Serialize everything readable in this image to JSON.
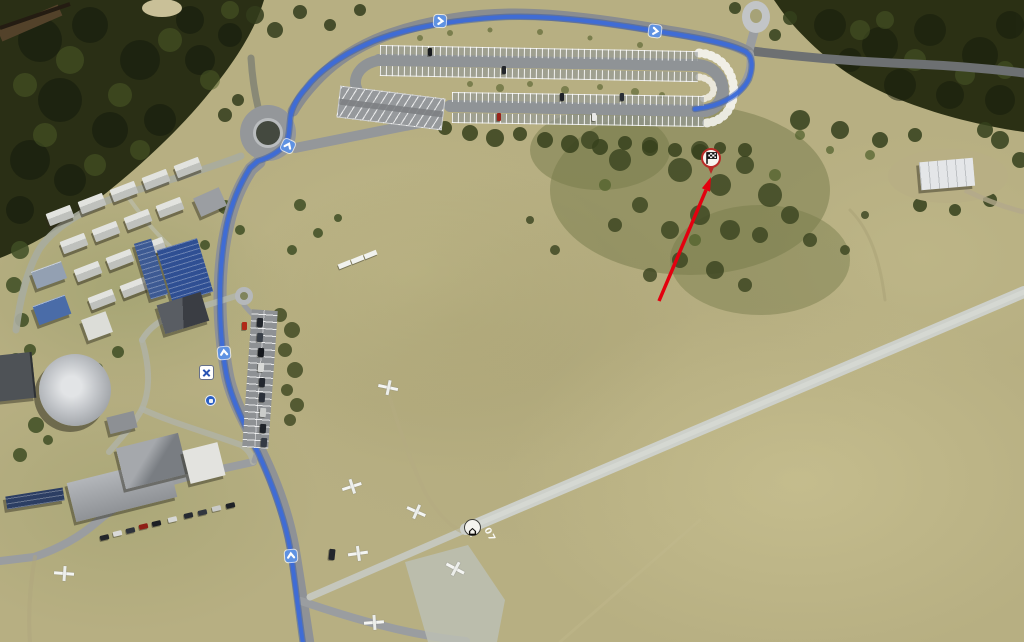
{
  "view": {
    "type": "aerial-satellite-route-map",
    "description": "Aerial imagery of a mountain airfield and resort village with a highlighted driving route, direction chevrons and a flagged destination marker"
  },
  "colors": {
    "route": "#3d6cd8",
    "route_casing": "#2b51ab",
    "annotation_red": "#e3000f",
    "pin_ring": "#b92b27",
    "chevron": "#5f92e2"
  },
  "markers": {
    "destination": {
      "icon": "checkered-flag",
      "shape": "circle-pin"
    },
    "house": {
      "icon": "house",
      "glyph": "⌂"
    },
    "crossing": {
      "icon": "blue-cross"
    },
    "info": {
      "icon": "blue-dot"
    }
  },
  "airfield": {
    "runway_number": "07"
  }
}
